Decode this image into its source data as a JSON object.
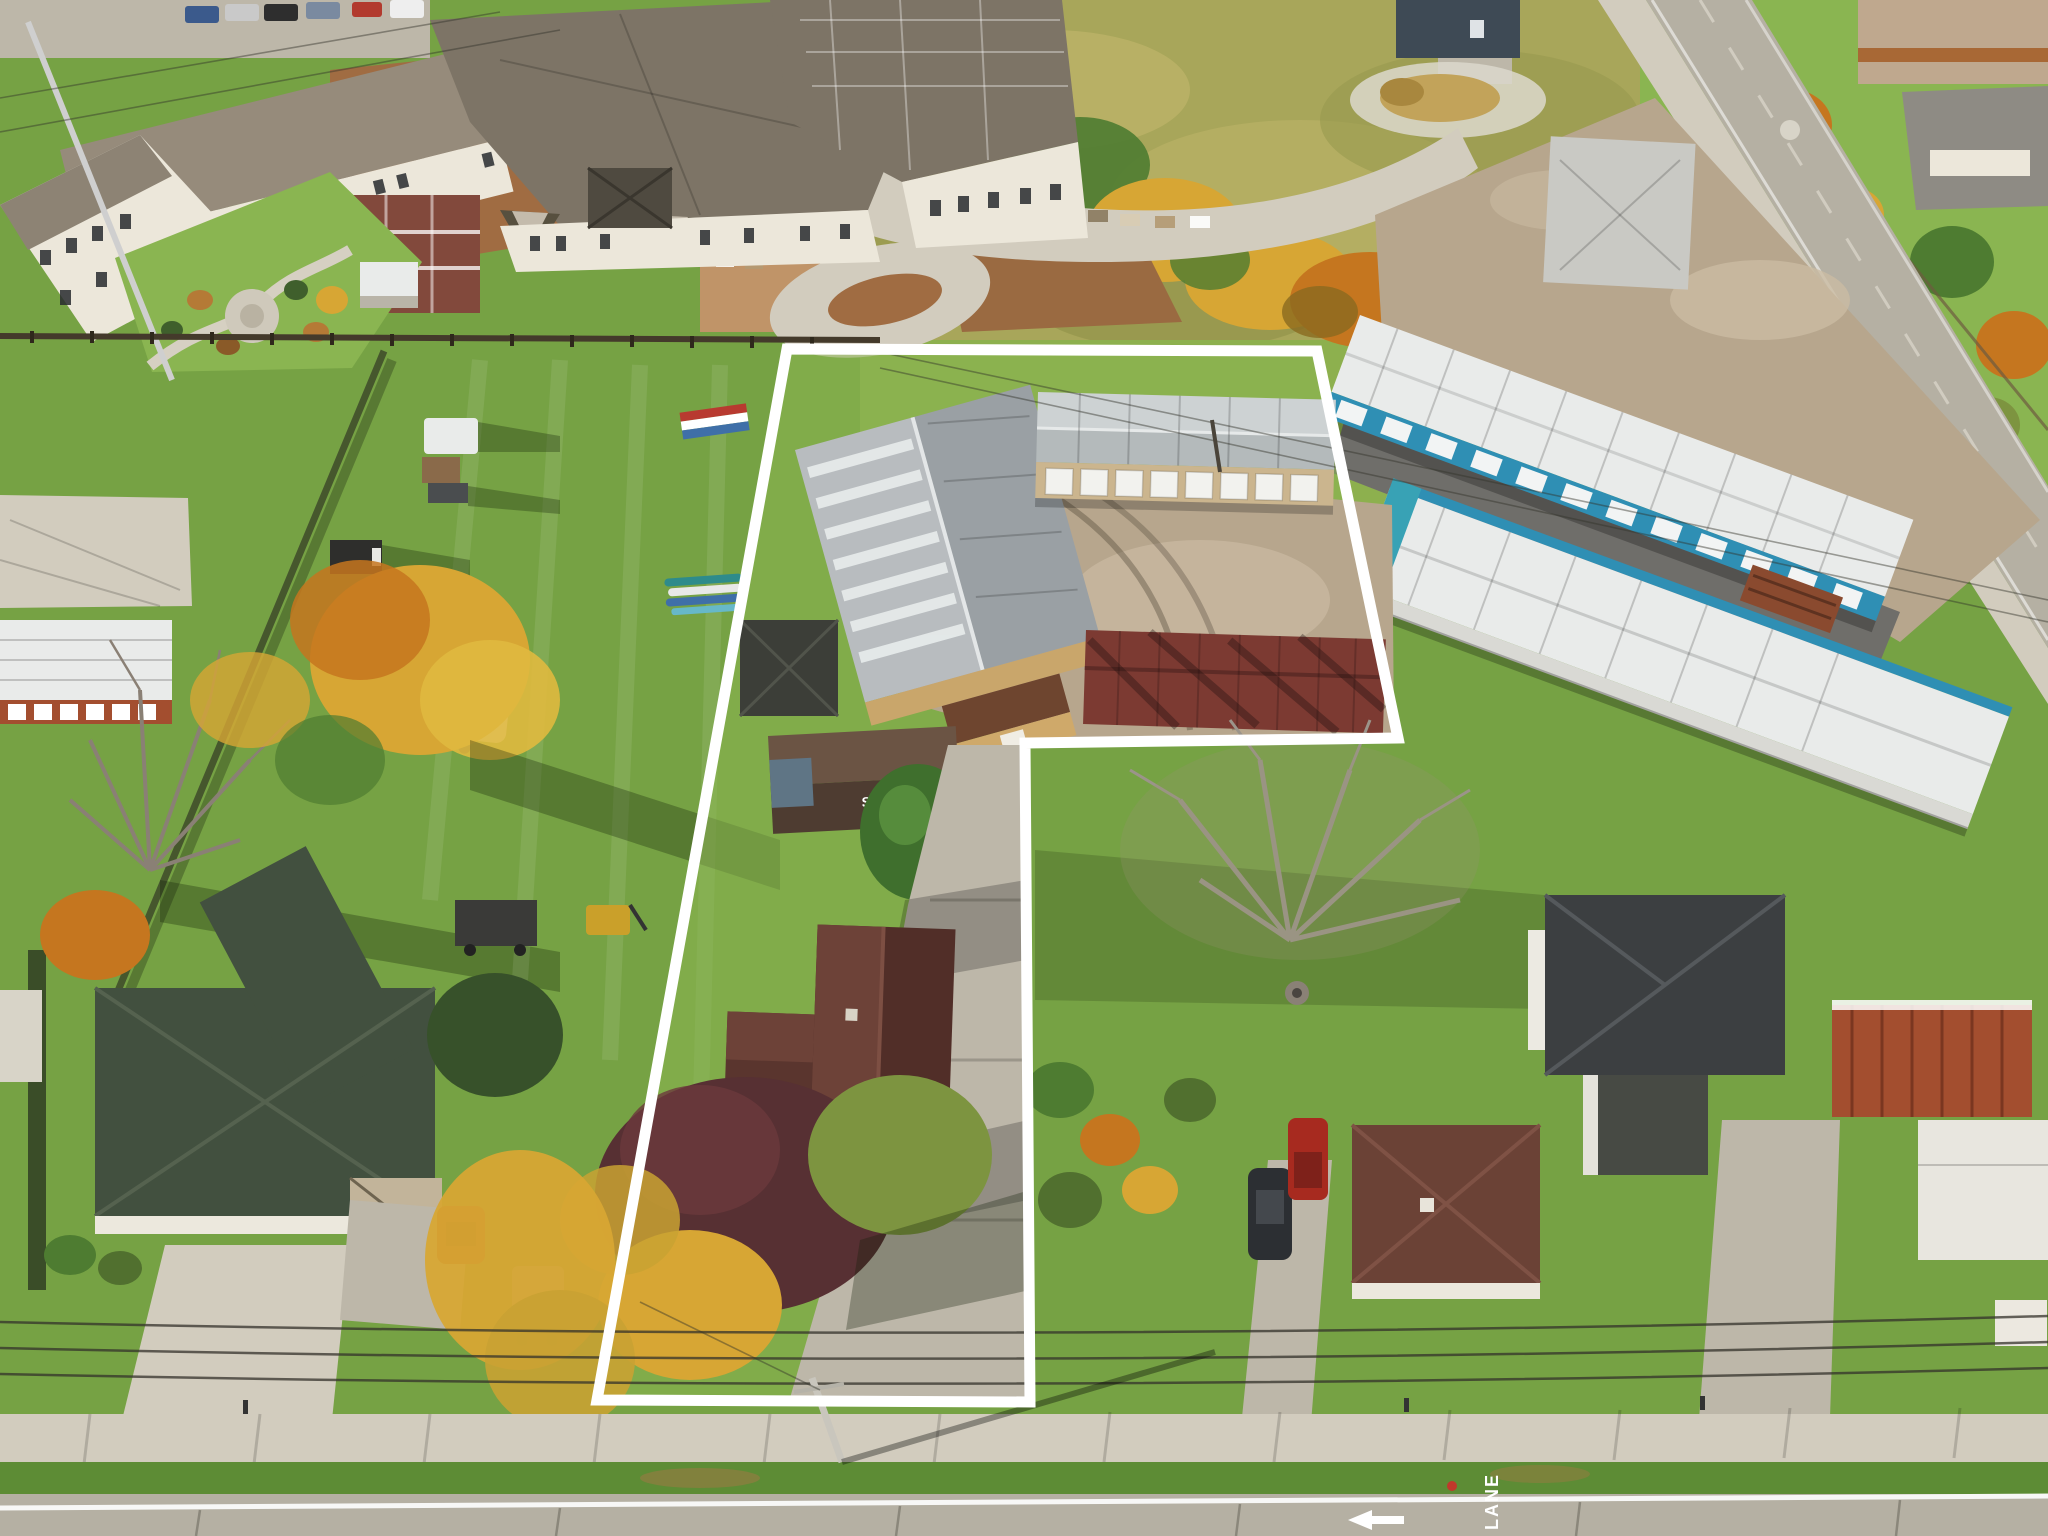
{
  "scene": {
    "kind": "aerial-drone-photo",
    "width": 2048,
    "height": 1536
  },
  "property_outline": {
    "points": "787,349 1317,351 1398,738 1025,743 1030,1402 597,1400",
    "stroke": "#ffffff",
    "stroke_width": 11
  },
  "road_markings": {
    "bike_lane_label": "LANE",
    "arrow_direction": "left"
  },
  "roof_sign": {
    "line1": "STORAGE",
    "line2": "388"
  },
  "palette": {
    "grass": "#76a244",
    "grass_bright": "#8ab551",
    "grass_dark": "#5d8c35",
    "field_olive": "#a8a65a",
    "field_light": "#bfb56a",
    "mowed_green": "#8db04e",
    "tree_yellow": "#d7a634",
    "tree_orange": "#c5761f",
    "tree_green": "#4e7c31",
    "tree_dark": "#37512a",
    "tree_maroon": "#573033",
    "conifer": "#3f6f2d",
    "dirt_brown": "#a06c42",
    "dirt_light": "#c09468",
    "concrete_light": "#d2ccbe",
    "concrete_mid": "#bdb7a9",
    "asphalt": "#6f6e6a",
    "road_gray": "#b5b0a3",
    "roof_taupe": "#968b7b",
    "roof_taupe_dark": "#7d7466",
    "roof_gable_light": "#c4bbac",
    "facade_cream": "#ece7da",
    "brick_red": "#82493c",
    "metal_silver": "#b8bcbf",
    "metal_silver_dark": "#9aa0a4",
    "roof_white": "#e9ebea",
    "storage_blue": "#2f8fb4",
    "storage_teal": "#38a2b5",
    "maroon_roof": "#7c3a32",
    "rust_roof": "#a34e2f",
    "house_dark_roof": "#3e4442",
    "house_brown_roof": "#5e3c33",
    "slate_green": "#42503f",
    "gravel": "#b7a68d",
    "gravel_light": "#cabba2",
    "pure_white": "#ffffff",
    "tan_wall": "#c9a66b",
    "pole_gray": "#c9c6bd",
    "car_red": "#a72a1f",
    "car_dark": "#2c2f33",
    "wire": "#34322b"
  }
}
